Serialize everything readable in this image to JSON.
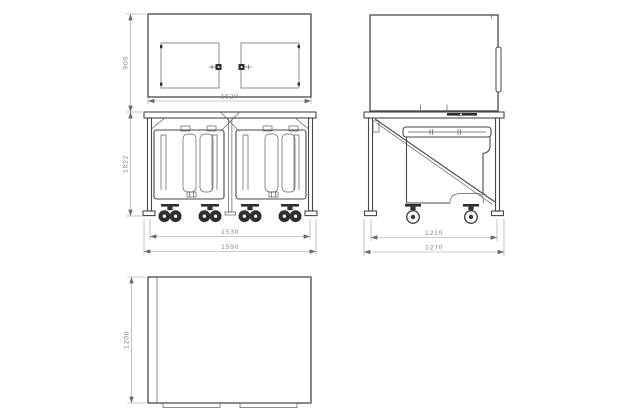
{
  "colors": {
    "background": "#ffffff",
    "geometry_line": "#474747",
    "dimension_line": "#979797",
    "dimension_text": "#8a8a8a",
    "dark_fill": "#2e2e2e"
  },
  "views": {
    "front": {
      "dims": {
        "upper_height": "900",
        "frame_height": "1022",
        "body_width": "1520",
        "caster_span": "1530",
        "overall_width": "1590"
      }
    },
    "side": {
      "dims": {
        "caster_span": "1210",
        "overall_depth": "1270"
      }
    },
    "plan": {
      "dims": {
        "depth": "1200"
      }
    }
  }
}
